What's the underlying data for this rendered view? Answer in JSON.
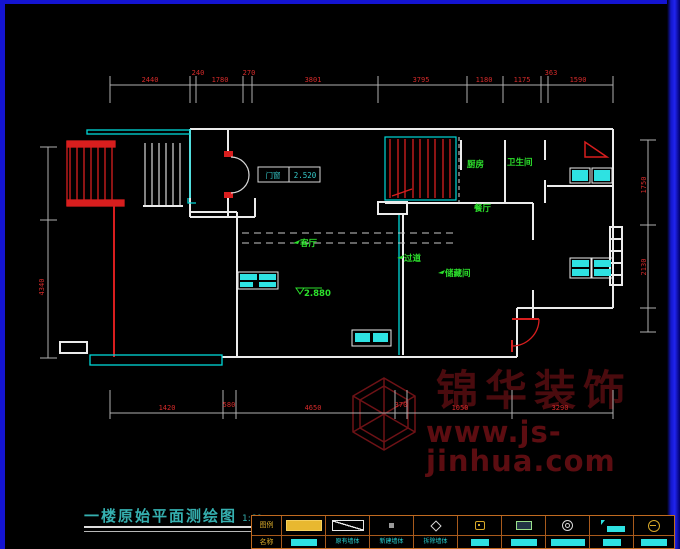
{
  "title": {
    "text": "一楼原始平面测绘图",
    "scale": "1:60"
  },
  "watermark": {
    "brand": "锦华装饰",
    "site": "www.js-jinhua.com"
  },
  "entry_tag": {
    "label": "门窗",
    "value": "2.520"
  },
  "elevation": {
    "value": "2.880"
  },
  "rooms": [
    {
      "text": "厨房"
    },
    {
      "text": "卫生间"
    },
    {
      "text": "餐厅"
    },
    {
      "text": "客厅"
    },
    {
      "text": "过道"
    },
    {
      "text": "储藏间"
    }
  ],
  "dimensions": {
    "top": [
      "2440",
      "240",
      "1780",
      "270",
      "3801",
      "3795",
      "1180",
      "1175",
      "363",
      "1590"
    ],
    "bottom": [
      "1420",
      "580",
      "4650",
      "370",
      "1050",
      "3290"
    ],
    "left": [
      "4340"
    ],
    "right": [
      "1750",
      "2130"
    ]
  },
  "legend": {
    "corner_top": "图例",
    "corner_bottom": "名称",
    "items": [
      {
        "icon": "filled-bar-yellow",
        "label": ""
      },
      {
        "icon": "rect-diagonal",
        "label": "原有墙体"
      },
      {
        "icon": "square-dot",
        "label": "新建墙体"
      },
      {
        "icon": "diamond",
        "label": "拆除墙体"
      },
      {
        "icon": "lock",
        "label": ""
      },
      {
        "icon": "appliance",
        "label": ""
      },
      {
        "icon": "circle-glyph",
        "label": ""
      },
      {
        "icon": "flag-bar",
        "label": ""
      },
      {
        "icon": "circle-minus",
        "label": ""
      }
    ]
  },
  "colors": {
    "wall": "#ebebeb",
    "red": "#d81e1e",
    "cyan": "#00d8d8",
    "cyan_fill": "#2ee2e2",
    "green": "#2ce02c",
    "dim_line": "#b0b0b0",
    "dim_text": "#d42a2a",
    "watermark": "#4a0b0e",
    "frame_blue": "#1414d2",
    "legend_border": "#c06a20",
    "title_teal": "#35b0b0"
  }
}
